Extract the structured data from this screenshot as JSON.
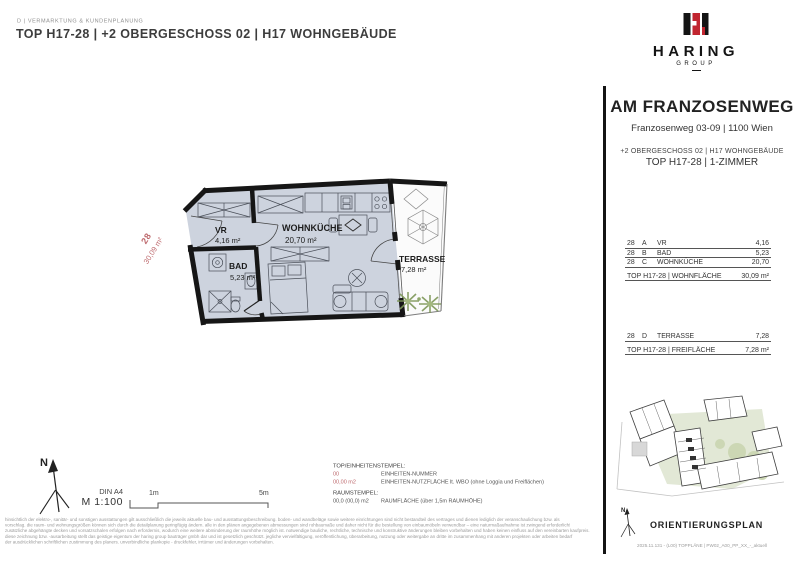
{
  "header": {
    "department": "D | VERMARKTUNG & KUNDENPLANUNG",
    "title": "TOP H17-28 | +2 OBERGESCHOSS 02 | H17 WOHNGEBÄUDE"
  },
  "logo": {
    "brand": "HARING",
    "group": "GROUP"
  },
  "project": {
    "name": "AM FRANZOSENWEG",
    "address": "Franzosenweg 03-09 | 1100 Wien",
    "floor_line": "+2 OBERGESCHOSS 02 | H17 WOHNGEBÄUDE",
    "unit_line": "TOP H17-28 | 1-ZIMMER"
  },
  "living_table": {
    "rows": [
      {
        "unit": "28",
        "key": "A",
        "room": "VR",
        "area": "4,16"
      },
      {
        "unit": "28",
        "key": "B",
        "room": "BAD",
        "area": "5,23"
      },
      {
        "unit": "28",
        "key": "C",
        "room": "WOHNKÜCHE",
        "area": "20,70"
      }
    ],
    "total_label": "TOP H17-28 | WOHNFLÄCHE",
    "total_value": "30,09 m²"
  },
  "outdoor_table": {
    "rows": [
      {
        "unit": "28",
        "key": "D",
        "room": "TERRASSE",
        "area": "7,28"
      }
    ],
    "total_label": "TOP H17-28 | FREIFLÄCHE",
    "total_value": "7,28 m²"
  },
  "plan": {
    "stamp_number": "28",
    "stamp_area": "30,09 m²",
    "rooms": {
      "vr": {
        "name": "VR",
        "area": "4,16 m²"
      },
      "bad": {
        "name": "BAD",
        "area": "5,23 m²"
      },
      "wohnkueche": {
        "name": "WOHNKÜCHE",
        "area": "20,70 m²"
      },
      "terrasse": {
        "name": "TERRASSE",
        "area": "7,28 m²"
      }
    }
  },
  "scale_block": {
    "paper": "DIN A4",
    "scale": "M 1:100",
    "mark_1": "1m",
    "mark_5": "5m",
    "north": "N"
  },
  "stamp_legend": {
    "title": "TOP/EINHEITENSTEMPEL:",
    "rows": [
      {
        "sample": "00",
        "desc": "EINHEITEN-NUMMER"
      },
      {
        "sample": "00,00 m2",
        "desc": "EINHEITEN-NUTZFLÄCHE lt. WBO (ohne Loggia und Freiflächen)"
      }
    ],
    "room_title": "RAUMSTEMPEL:",
    "room_sample": "00,0 (00,0) m2",
    "room_desc": "RAUMFLÄCHE (über 1,5m RAUMHÖHE)"
  },
  "disclaimer": {
    "lines": [
      "hinsichtlich der elektro-, sanitär- und sonstigen ausstattungen gilt ausschließlich die jeweils aktuelle bau- und ausstattungsbeschreibung. boden- und wandbeläge sowie weitere einrichtungen sind nicht bestandteil des vertrages und dienen lediglich der veranschaulichung bzw. als",
      "vorschlag. die raum- und wohnungsgrößen können sich durch die detailplanung geringfügig ändern. alle in den plänen angegebenen abmessungen sind rohbaumaße und daher nicht für die bestellung von einbaumöbeln verwendbar – eine naturmaßaufnahme ist zwingend erforderlich!",
      "zusätzliche abgehängte decken und vorsatzschalen erfolgen nach erfordernis, wodurch eine weitere abminderung der raumhöhe möglich ist. notwendige bauliche, rechtliche, technische und konstruktive änderungen bleiben vorbehalten und haben keinen einfluss auf den vereinbarten kaufpreis.",
      "diese zeichnung bzw. -ausarbeitung stellt das geistige eigentum der haring group bauträger gmbh dar und ist gesetzlich geschützt. jegliche vervielfältigung, veröffentlichung, überarbeitung, nutzung oder weitergabe an dritte im zusammenhang mit anderen projekten oder arbeiten bedarf",
      "der ausdrücklichen schriftlichen zustimmung des planers. unverbindliche plankopie - druckfehler, irrtümer und änderungen vorbehalten."
    ]
  },
  "orientation": {
    "title": "ORIENTIERUNGSPLAN",
    "north": "N",
    "file_info": "2025.11.131 - (L00) TOPPLÄNE | PW02_A00_PP_XX_-_aktuell"
  },
  "colors": {
    "logo_red": "#c1252f",
    "stamp_red": "#bd686c",
    "wall_black": "#161616",
    "floor_fill": "#cdd3de",
    "plant_green": "#7d9758",
    "site_green": "#e2e8d6"
  }
}
